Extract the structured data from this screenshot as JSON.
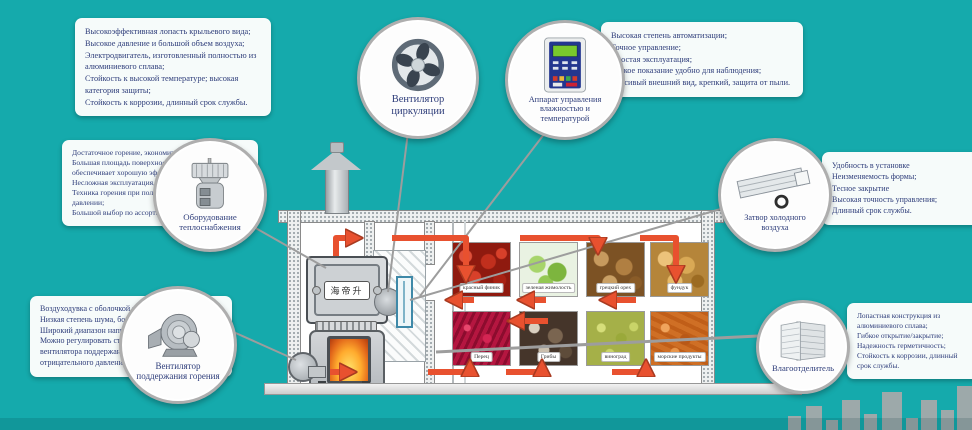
{
  "colors": {
    "background": "#15aaac",
    "arrow": "#e8512f",
    "text": "#2e3d7a"
  },
  "callouts": [
    {
      "id": "circulation-fan",
      "label": "Вентилятор циркуляции",
      "features": [
        "Высокоэффективная лопасть крыльевого вида;",
        "Высокое давление и большой объем воздуха;",
        "Электродвигатель, изготовленный полностью из алюминиевого сплава;",
        "Стойкость к высокой температуре; высокая категория защиты;",
        "Стойкость к коррозии, длинный срок службы."
      ]
    },
    {
      "id": "control-device",
      "label": "Аппарат управления влажностью и температурой",
      "features": [
        "Высокая степень автоматизации;",
        "Точное управление;",
        "Простая эксплуатация;",
        "Четкое показание удобно для наблюдения;",
        "Красивый внешний вид, крепкий, защита от пыли."
      ]
    },
    {
      "id": "heating-equipment",
      "label": "Оборудование теплоснабжения",
      "features": [
        "Достаточное горение, экономит рассеяние топлива;",
        "Большая площадь поверхности теплообмена обеспечивает хорошую эффективность теплообмена;",
        "Несложная эксплуатация, удобно для очистки;",
        "Техника горения при положительном/отрицательном давлении;",
        "Большой выбор по ассортиментам угля."
      ]
    },
    {
      "id": "cold-air-valve",
      "label": "Затвор холодного воздуха",
      "features": [
        "Удобность в установке",
        "Неизменяемость формы;",
        "Тесное закрытие",
        "Высокая точность управления;",
        "Длинный срок службы."
      ]
    },
    {
      "id": "combustion-fan",
      "label": "Вентилятор поддержания горения",
      "features": [
        "Воздуходувка с оболочкой из листовой стали;",
        "Низкая степень шума, большое количество дутья;",
        "Широкий диапазон напряжения 220В+/-20%S",
        "Можно регулировать степень одновременно вентилятора поддержания горения положительного и отрицательного давления."
      ]
    },
    {
      "id": "moisture-separator",
      "label": "Влагоотделитель",
      "features": [
        "Лопастная конструкция из алюминиевого сплава;",
        "Гибкое открытие/закрытие;",
        "Надежность герметичность;",
        "Стойкость к коррозии, длинный срок службы."
      ]
    }
  ],
  "diagram": {
    "furnace_brand": "海帝升"
  },
  "products": [
    {
      "label": "красный финик"
    },
    {
      "label": "зеленая жимолость"
    },
    {
      "label": "грецкий орех"
    },
    {
      "label": "фундук"
    },
    {
      "label": "Перец"
    },
    {
      "label": "Грибы"
    },
    {
      "label": "виноград"
    },
    {
      "label": "морские продукты"
    }
  ]
}
